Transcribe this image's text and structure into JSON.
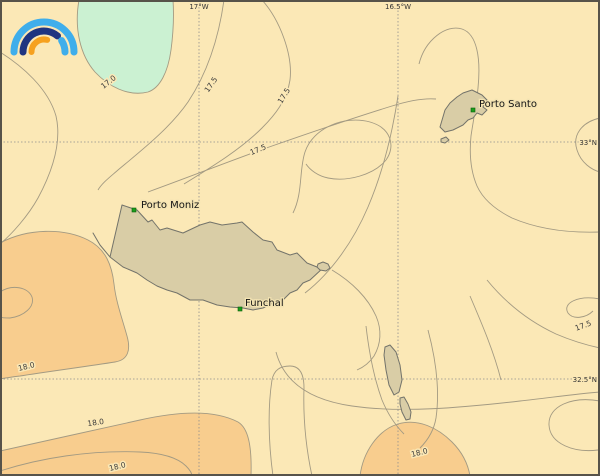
{
  "map": {
    "type": "contour-weather-map",
    "region": "Madeira archipelago",
    "grid": {
      "meridians": [
        {
          "label": "17°W",
          "x": 199
        },
        {
          "label": "16.5°W",
          "x": 398
        }
      ],
      "parallels": [
        {
          "label": "33°N",
          "y": 142
        },
        {
          "label": "32.5°N",
          "y": 379
        }
      ]
    },
    "places": [
      {
        "name": "Porto Moniz",
        "marker_x": 134,
        "marker_y": 210
      },
      {
        "name": "Funchal",
        "marker_x": 240,
        "marker_y": 309
      },
      {
        "name": "Porto Santo",
        "marker_x": 473,
        "marker_y": 110
      }
    ],
    "contour_labels": [
      {
        "value": "17.0",
        "x": 110,
        "y": 84,
        "angle": -38
      },
      {
        "value": "17.5",
        "x": 213,
        "y": 86,
        "angle": -55
      },
      {
        "value": "17.5",
        "x": 286,
        "y": 97,
        "angle": -58
      },
      {
        "value": "17.5",
        "x": 259,
        "y": 152,
        "angle": -22
      },
      {
        "value": "17.5",
        "x": 584,
        "y": 328,
        "angle": -20
      },
      {
        "value": "18.0",
        "x": 27,
        "y": 369,
        "angle": -14
      },
      {
        "value": "18.0",
        "x": 96,
        "y": 425,
        "angle": -8
      },
      {
        "value": "18.0",
        "x": 118,
        "y": 469,
        "angle": -14
      },
      {
        "value": "18.0",
        "x": 420,
        "y": 455,
        "angle": -14
      }
    ],
    "colors": {
      "sea_base": "#FBE8B6",
      "cool_band": "#CBF1D2",
      "warm_band": "#F8CD8E",
      "island_fill": "#D9CDA6",
      "island_stroke": "#73736a",
      "contour_stroke": "#A39A82",
      "marker_green": "#1B9E1B",
      "logo_light_blue": "#3FAEEB",
      "logo_dark_blue": "#1F3480",
      "logo_orange": "#F6A11F"
    }
  }
}
